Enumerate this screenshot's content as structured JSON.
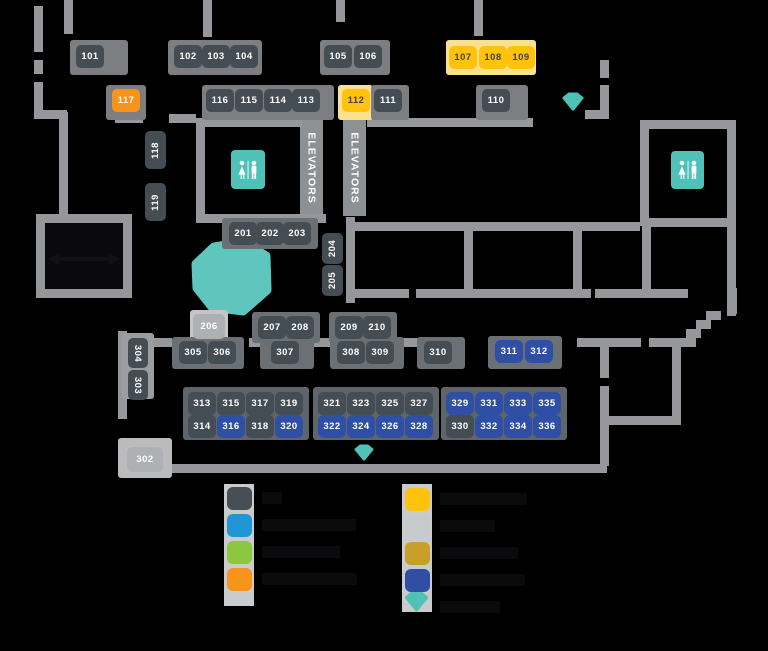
{
  "map": {
    "labels": {
      "elevators": "ELEVATORS"
    },
    "colors": {
      "wall": "#95979a",
      "booth_gray": "#454d54",
      "booth_yellow": "#ffc20d",
      "booth_orange": "#f7941e",
      "booth_blue": "#2e4fa3",
      "booth_silver": "#aeb0b3",
      "teal": "#4fc1b6",
      "pale_yellow_plate": "#f9e18e"
    },
    "booths": [
      {
        "n": "101",
        "x": 76,
        "y": 45,
        "c": "g"
      },
      {
        "n": "102",
        "x": 174,
        "y": 45,
        "c": "g"
      },
      {
        "n": "103",
        "x": 202,
        "y": 45,
        "c": "g"
      },
      {
        "n": "104",
        "x": 230,
        "y": 45,
        "c": "g"
      },
      {
        "n": "105",
        "x": 324,
        "y": 45,
        "c": "g"
      },
      {
        "n": "106",
        "x": 354,
        "y": 45,
        "c": "g"
      },
      {
        "n": "107",
        "x": 449,
        "y": 46,
        "c": "y"
      },
      {
        "n": "108",
        "x": 479,
        "y": 46,
        "c": "y"
      },
      {
        "n": "109",
        "x": 507,
        "y": 46,
        "c": "y"
      },
      {
        "n": "117",
        "x": 112,
        "y": 89,
        "c": "o"
      },
      {
        "n": "116",
        "x": 206,
        "y": 89,
        "c": "g"
      },
      {
        "n": "115",
        "x": 235,
        "y": 89,
        "c": "g"
      },
      {
        "n": "114",
        "x": 264,
        "y": 89,
        "c": "g"
      },
      {
        "n": "113",
        "x": 292,
        "y": 89,
        "c": "g"
      },
      {
        "n": "112",
        "x": 342,
        "y": 89,
        "c": "y"
      },
      {
        "n": "111",
        "x": 374,
        "y": 89,
        "c": "g"
      },
      {
        "n": "110",
        "x": 482,
        "y": 89,
        "c": "g"
      },
      {
        "n": "118",
        "x": 145,
        "y": 131,
        "w": 21,
        "h": 38,
        "c": "g",
        "r": "ccw"
      },
      {
        "n": "119",
        "x": 145,
        "y": 183,
        "w": 21,
        "h": 38,
        "c": "g",
        "r": "ccw"
      },
      {
        "n": "201",
        "x": 229,
        "y": 222,
        "c": "g"
      },
      {
        "n": "202",
        "x": 256,
        "y": 222,
        "c": "g"
      },
      {
        "n": "203",
        "x": 283,
        "y": 222,
        "c": "g"
      },
      {
        "n": "204",
        "x": 322,
        "y": 233,
        "w": 21,
        "h": 31,
        "c": "g",
        "r": "ccw"
      },
      {
        "n": "205",
        "x": 322,
        "y": 265,
        "w": 21,
        "h": 31,
        "c": "g",
        "r": "ccw"
      },
      {
        "n": "206",
        "x": 193,
        "y": 314,
        "w": 32,
        "h": 25,
        "c": "s"
      },
      {
        "n": "207",
        "x": 258,
        "y": 316,
        "c": "g"
      },
      {
        "n": "208",
        "x": 286,
        "y": 316,
        "c": "g"
      },
      {
        "n": "209",
        "x": 335,
        "y": 316,
        "c": "g"
      },
      {
        "n": "210",
        "x": 363,
        "y": 316,
        "c": "g"
      },
      {
        "n": "304",
        "x": 128,
        "y": 338,
        "w": 20,
        "h": 30,
        "c": "g",
        "r": "cw"
      },
      {
        "n": "303",
        "x": 128,
        "y": 370,
        "w": 20,
        "h": 30,
        "c": "g",
        "r": "cw"
      },
      {
        "n": "305",
        "x": 179,
        "y": 341,
        "c": "g"
      },
      {
        "n": "306",
        "x": 208,
        "y": 341,
        "c": "g"
      },
      {
        "n": "307",
        "x": 271,
        "y": 341,
        "c": "g"
      },
      {
        "n": "308",
        "x": 337,
        "y": 341,
        "c": "g"
      },
      {
        "n": "309",
        "x": 366,
        "y": 341,
        "c": "g"
      },
      {
        "n": "310",
        "x": 424,
        "y": 341,
        "c": "g"
      },
      {
        "n": "311",
        "x": 495,
        "y": 340,
        "c": "b"
      },
      {
        "n": "312",
        "x": 525,
        "y": 340,
        "c": "b"
      },
      {
        "n": "313",
        "x": 188,
        "y": 392,
        "c": "g"
      },
      {
        "n": "315",
        "x": 217,
        "y": 392,
        "c": "g"
      },
      {
        "n": "317",
        "x": 246,
        "y": 392,
        "c": "g"
      },
      {
        "n": "319",
        "x": 275,
        "y": 392,
        "c": "g"
      },
      {
        "n": "314",
        "x": 188,
        "y": 415,
        "c": "g"
      },
      {
        "n": "316",
        "x": 217,
        "y": 415,
        "c": "b"
      },
      {
        "n": "318",
        "x": 246,
        "y": 415,
        "c": "g"
      },
      {
        "n": "320",
        "x": 275,
        "y": 415,
        "c": "b"
      },
      {
        "n": "321",
        "x": 318,
        "y": 392,
        "c": "g"
      },
      {
        "n": "323",
        "x": 347,
        "y": 392,
        "c": "g"
      },
      {
        "n": "325",
        "x": 376,
        "y": 392,
        "c": "g"
      },
      {
        "n": "327",
        "x": 405,
        "y": 392,
        "c": "g"
      },
      {
        "n": "322",
        "x": 318,
        "y": 415,
        "c": "b"
      },
      {
        "n": "324",
        "x": 347,
        "y": 415,
        "c": "b"
      },
      {
        "n": "326",
        "x": 376,
        "y": 415,
        "c": "b"
      },
      {
        "n": "328",
        "x": 405,
        "y": 415,
        "c": "b"
      },
      {
        "n": "329",
        "x": 446,
        "y": 392,
        "c": "b"
      },
      {
        "n": "331",
        "x": 475,
        "y": 392,
        "c": "b"
      },
      {
        "n": "333",
        "x": 504,
        "y": 392,
        "c": "b"
      },
      {
        "n": "335",
        "x": 533,
        "y": 392,
        "c": "b"
      },
      {
        "n": "330",
        "x": 446,
        "y": 415,
        "c": "g"
      },
      {
        "n": "332",
        "x": 475,
        "y": 415,
        "c": "b"
      },
      {
        "n": "334",
        "x": 504,
        "y": 415,
        "c": "b"
      },
      {
        "n": "336",
        "x": 533,
        "y": 415,
        "c": "b"
      },
      {
        "n": "302",
        "x": 127,
        "y": 447,
        "w": 36,
        "h": 25,
        "c": "s"
      }
    ],
    "legend": {
      "left": [
        {
          "swatch": "#474e55",
          "label": ""
        },
        {
          "swatch": "#1f97d4",
          "label": ""
        },
        {
          "swatch": "#8dc63f",
          "label": ""
        },
        {
          "swatch": "#f7941e",
          "label": ""
        }
      ],
      "right": [
        {
          "swatch": "#ffc20d",
          "label": ""
        },
        {
          "swatch": "#c7c9ca",
          "label": ""
        },
        {
          "swatch": "#c79f2a",
          "label": ""
        },
        {
          "swatch": "#2e4fa3",
          "label": ""
        },
        {
          "swatch": "gem",
          "label": ""
        }
      ]
    }
  }
}
